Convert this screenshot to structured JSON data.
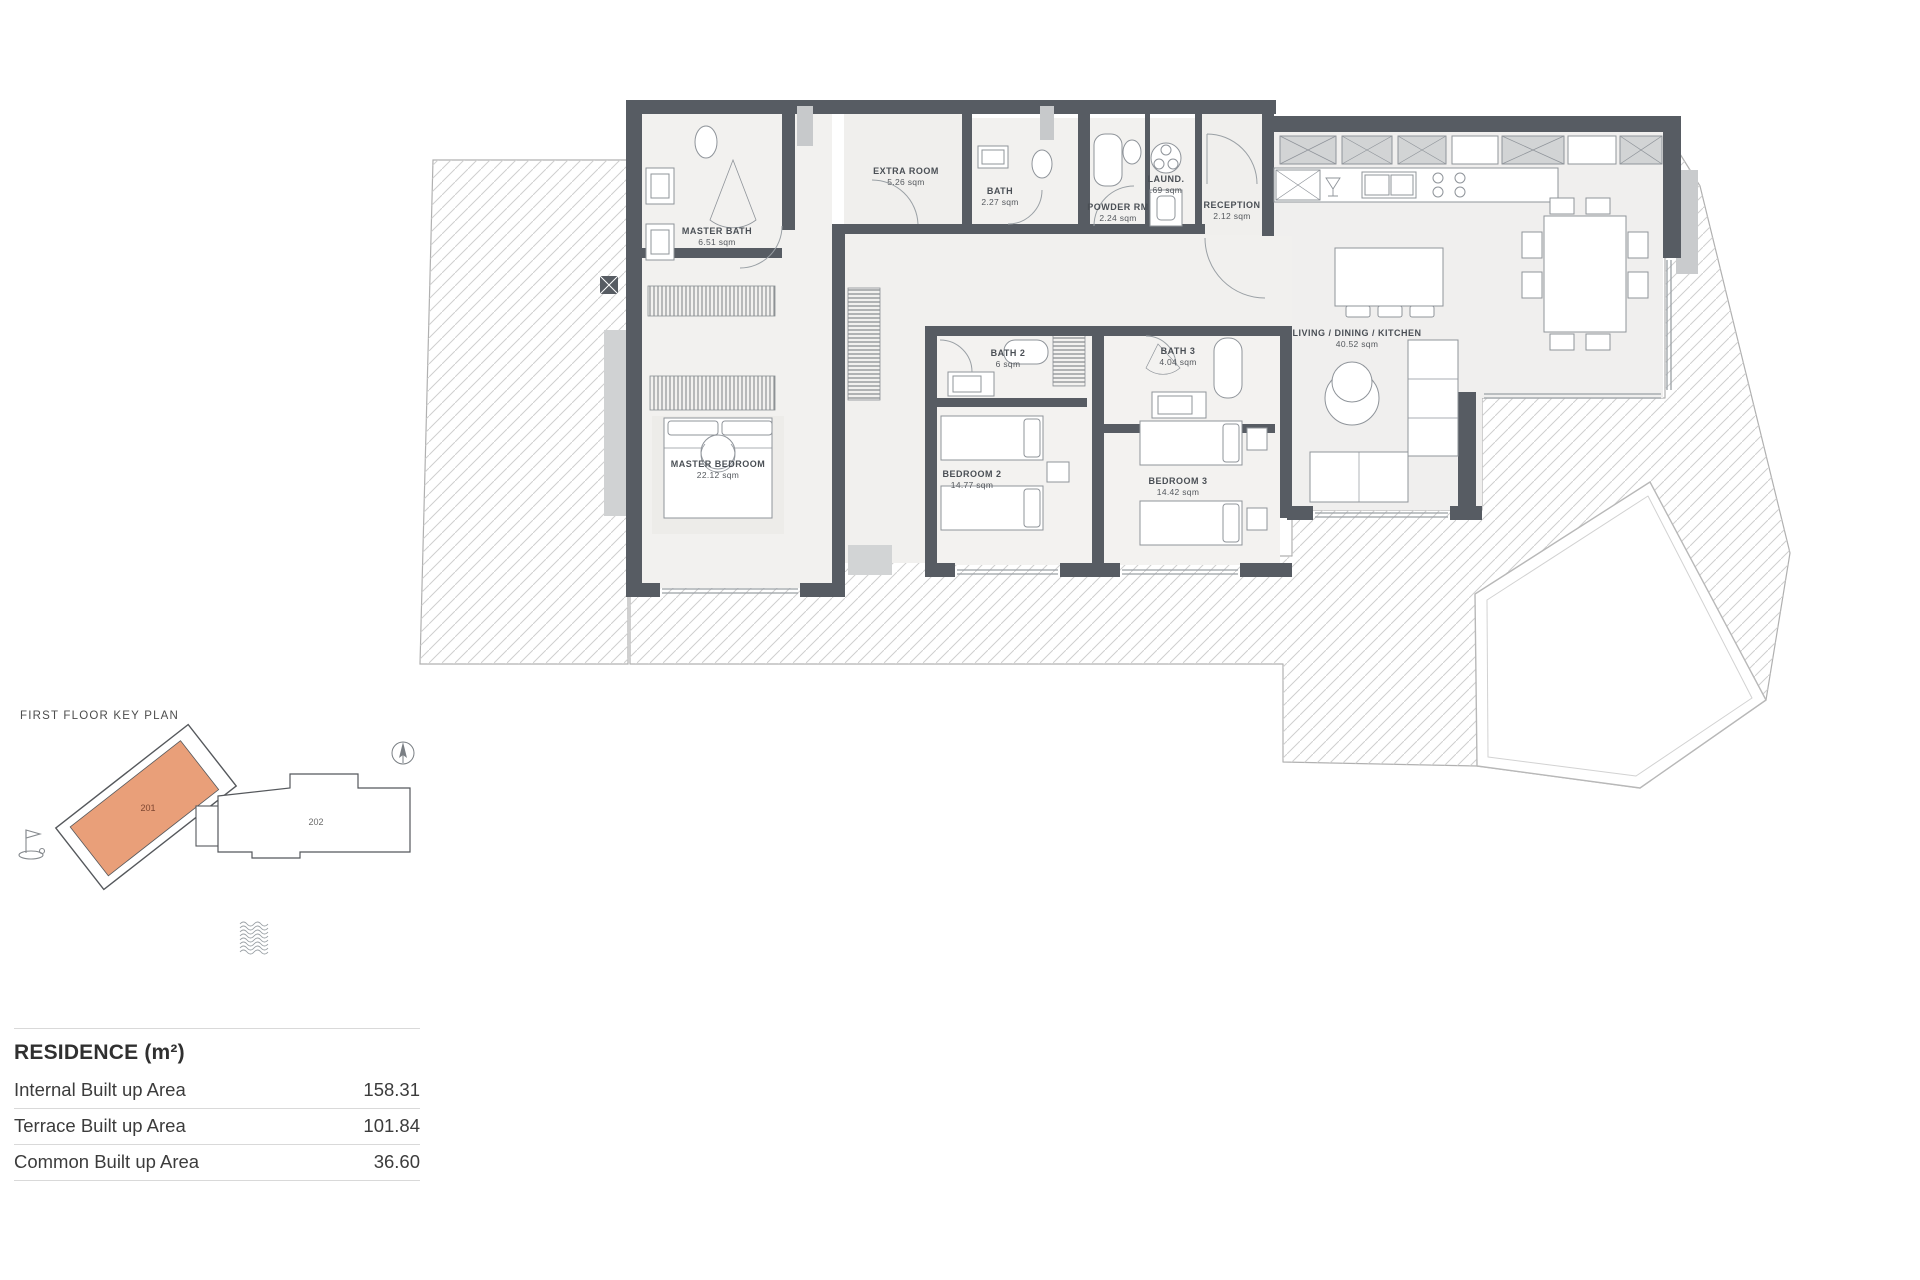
{
  "plan": {
    "rooms": [
      {
        "name": "MASTER BATH",
        "area": "6.51 sqm"
      },
      {
        "name": "EXTRA ROOM",
        "area": "5.26 sqm"
      },
      {
        "name": "BATH",
        "area": "2.27 sqm"
      },
      {
        "name": "POWDER RM",
        "area": "2.24 sqm"
      },
      {
        "name": "LAUND.",
        "area": ".69 sqm"
      },
      {
        "name": "RECEPTION",
        "area": "2.12 sqm"
      },
      {
        "name": "LIVING / DINING / KITCHEN",
        "area": "40.52 sqm"
      },
      {
        "name": "MASTER BEDROOM",
        "area": "22.12 sqm"
      },
      {
        "name": "BATH 2",
        "area": "6 sqm"
      },
      {
        "name": "BATH 3",
        "area": "4.04 sqm"
      },
      {
        "name": "BEDROOM 2",
        "area": "14.77 sqm"
      },
      {
        "name": "BEDROOM 3",
        "area": "14.42 sqm"
      }
    ]
  },
  "key_plan": {
    "title": "FIRST FLOOR KEY PLAN",
    "highlighted_unit": "201",
    "other_unit": "202",
    "highlight_color": "#E99F79"
  },
  "residence": {
    "title": "RESIDENCE (m²)",
    "rows": [
      {
        "label": "Internal Built up Area",
        "value": "158.31"
      },
      {
        "label": "Terrace Built up Area",
        "value": "101.84"
      },
      {
        "label": "Common Built up Area",
        "value": "36.60"
      }
    ]
  }
}
